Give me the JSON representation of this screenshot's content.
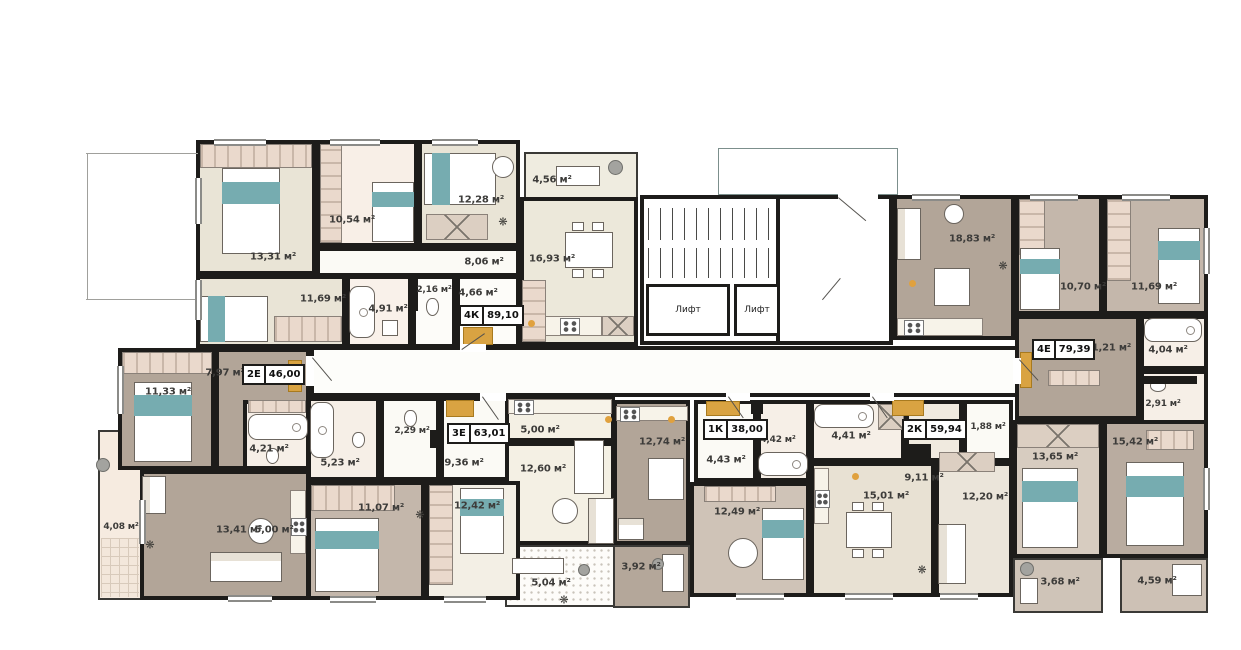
{
  "plan_title": "apartment-floor-plan",
  "palette": {
    "wall": "#1d1c1a",
    "cream": "#e9e4d6",
    "brown": "#b2a598",
    "greige": "#c4b7ab",
    "pink": "#f8efe7",
    "teal": "#76acb0",
    "accent_orange": "#d9a342"
  },
  "core": {
    "elevators": [
      "Лифт",
      "Лифт"
    ]
  },
  "apartments": [
    {
      "type": "4К",
      "total_area": "89,10",
      "rooms": [
        {
          "name": "bedroom-1",
          "label": "13,31 м²"
        },
        {
          "name": "bedroom-2",
          "label": "10,54 м²"
        },
        {
          "name": "bedroom-3",
          "label": "12,28 м²"
        },
        {
          "name": "hall",
          "label": "8,06 м²"
        },
        {
          "name": "kitchen-living",
          "label": "16,93 м²"
        },
        {
          "name": "bedroom-4",
          "label": "11,69 м²"
        },
        {
          "name": "bathroom",
          "label": "4,91 м²"
        },
        {
          "name": "wc",
          "label": "2,16 м²"
        },
        {
          "name": "entry-hall",
          "label": "4,66 м²"
        }
      ],
      "balcony": {
        "label": "4,56 м²"
      }
    },
    {
      "type": "2Е",
      "total_area": "46,00",
      "rooms": [
        {
          "name": "bedroom",
          "label": "11,33 м²"
        },
        {
          "name": "hall",
          "label": "7,97 м²"
        },
        {
          "name": "bathroom",
          "label": "4,21 м²"
        },
        {
          "name": "living",
          "label": "13,41 м²"
        },
        {
          "name": "kitchen",
          "label": "5,00 м²"
        }
      ],
      "balcony": {
        "label": "4,08 м²"
      }
    },
    {
      "type": "3Е",
      "total_area": "63,01",
      "rooms": [
        {
          "name": "bathroom",
          "label": "5,23 м²"
        },
        {
          "name": "wc",
          "label": "2,29 м²"
        },
        {
          "name": "hall",
          "label": "9,36 м²"
        },
        {
          "name": "kitchen",
          "label": "5,00 м²"
        },
        {
          "name": "living",
          "label": "12,60 м²"
        },
        {
          "name": "bedroom-1",
          "label": "11,07 м²"
        },
        {
          "name": "bedroom-2",
          "label": "12,42 м²"
        }
      ],
      "balcony": {
        "label": "5,04 м²"
      }
    },
    {
      "type": "1К",
      "total_area": "38,00",
      "rooms": [
        {
          "name": "kitchen-living",
          "label": "12,74 м²"
        },
        {
          "name": "hall",
          "label": "4,43 м²"
        },
        {
          "name": "bathroom",
          "label": "4,42 м²"
        },
        {
          "name": "bedroom",
          "label": "12,49 м²"
        }
      ],
      "balcony": {
        "label": "3,92 м²"
      }
    },
    {
      "type": "2К",
      "total_area": "59,94",
      "rooms": [
        {
          "name": "bathroom",
          "label": "4,41 м²"
        },
        {
          "name": "hall",
          "label": "9,11 м²"
        },
        {
          "name": "storage",
          "label": "1,88 м²"
        },
        {
          "name": "living",
          "label": "15,01 м²"
        },
        {
          "name": "kitchen",
          "label": "12,20 м²"
        },
        {
          "name": "bedroom",
          "label": "13,65 м²"
        }
      ],
      "balcony": {
        "label": "3,68 м²"
      }
    },
    {
      "type": "4Е",
      "total_area": "79,39",
      "rooms": [
        {
          "name": "kitchen-living",
          "label": "18,83 м²"
        },
        {
          "name": "bedroom-1",
          "label": "10,70 м²"
        },
        {
          "name": "bedroom-2",
          "label": "11,69 м²"
        },
        {
          "name": "hall",
          "label": "11,21 м²"
        },
        {
          "name": "bathroom",
          "label": "4,04 м²"
        },
        {
          "name": "wc",
          "label": "2,91 м²"
        },
        {
          "name": "bedroom-3",
          "label": "15,42 м²"
        }
      ],
      "balcony": {
        "label": "4,59 м²"
      }
    }
  ]
}
